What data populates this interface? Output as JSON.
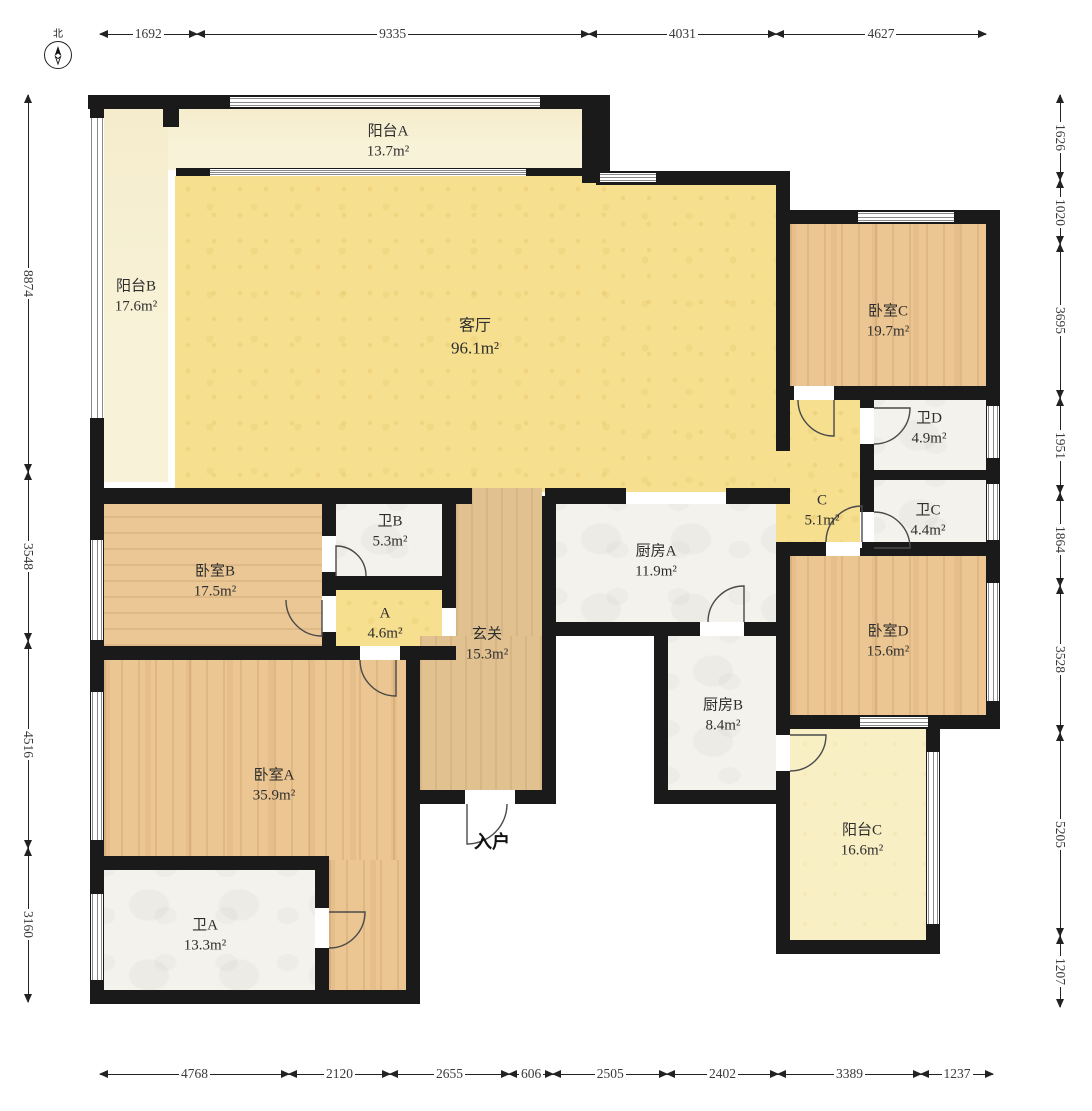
{
  "compass": {
    "north_label": "北"
  },
  "entrance": {
    "label": "入户"
  },
  "rooms": {
    "balcony_a": {
      "label": "阳台A",
      "area": "13.7m²"
    },
    "balcony_b": {
      "label": "阳台B",
      "area": "17.6m²"
    },
    "living_room": {
      "label": "客厅",
      "area": "96.1m²"
    },
    "bedroom_c": {
      "label": "卧室C",
      "area": "19.7m²"
    },
    "bath_d": {
      "label": "卫D",
      "area": "4.9m²"
    },
    "bath_c": {
      "label": "卫C",
      "area": "4.4m²"
    },
    "corridor_c": {
      "label": "C",
      "area": "5.1m²"
    },
    "kitchen_a": {
      "label": "厨房A",
      "area": "11.9m²"
    },
    "bedroom_d": {
      "label": "卧室D",
      "area": "15.6m²"
    },
    "bath_b": {
      "label": "卫B",
      "area": "5.3m²"
    },
    "bedroom_b": {
      "label": "卧室B",
      "area": "17.5m²"
    },
    "corridor_a": {
      "label": "A",
      "area": "4.6m²"
    },
    "entry_hall": {
      "label": "玄关",
      "area": "15.3m²"
    },
    "kitchen_b": {
      "label": "厨房B",
      "area": "8.4m²"
    },
    "bedroom_a": {
      "label": "卧室A",
      "area": "35.9m²"
    },
    "bath_a": {
      "label": "卫A",
      "area": "13.3m²"
    },
    "balcony_c": {
      "label": "阳台C",
      "area": "16.6m²"
    }
  },
  "dimensions": {
    "top": [
      "1692",
      "9335",
      "4031",
      "4627"
    ],
    "bottom": [
      "4768",
      "2120",
      "2655",
      "606",
      "2505",
      "2402",
      "3389",
      "1237"
    ],
    "left": [
      "8874",
      "3548",
      "4516",
      "3160"
    ],
    "right": [
      "1626",
      "1020",
      "3695",
      "1951",
      "1864",
      "3528",
      "5205",
      "1207"
    ]
  },
  "palette": {
    "wall": "#1a1a1a",
    "living_yellow": "#f6df8f",
    "wood": "#ebc693",
    "marble": "#f4f2ed",
    "balcony_cream": "#f8f2d8",
    "balcony_pale": "#f9efc4",
    "dimension_text": "#3a3a3a"
  }
}
